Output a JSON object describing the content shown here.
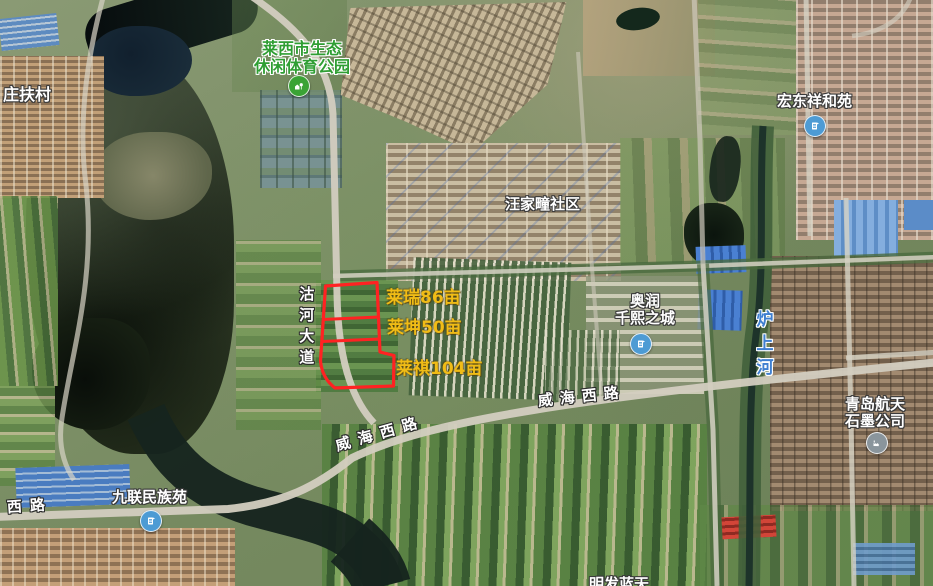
{
  "map": {
    "view": "satellite",
    "poi": {
      "zhuangfucun": {
        "label": "庄扶村"
      },
      "park": {
        "line1": "莱西市生态",
        "line2": "休闲体育公园"
      },
      "hongdong": {
        "label": "宏东祥和苑"
      },
      "wangjiatuan": {
        "label": "汪家疃社区"
      },
      "aorun": {
        "line1": "奥润",
        "line2": "千熙之城"
      },
      "jiulian": {
        "label": "九联民族苑"
      },
      "graphite": {
        "line1": "青岛航天",
        "line2": "石墨公司"
      },
      "bottom_partial": {
        "label": "明发蓝天"
      }
    },
    "roads": {
      "guhe_dadao": "沽河大道",
      "weihai_xilu_east": "威海西路",
      "weihai_xilu_west": "威海西路",
      "weihai_xilu_edge": "海西路"
    },
    "waters": {
      "lushanghe": "炉上河"
    },
    "parcels": [
      {
        "label": "莱瑞86亩"
      },
      {
        "label": "莱坤50亩"
      },
      {
        "label": "莱祺104亩"
      }
    ],
    "colors": {
      "parcel_outline": "#ff2222",
      "parcel_label": "#f0bc16",
      "poi_label": "#ffffff",
      "park_label": "#2f9e33",
      "water_label": "#3f7fd0",
      "park_icon": "#3aa335",
      "residential_icon": "#4d9bd4",
      "factory_icon": "#8a959c"
    }
  }
}
